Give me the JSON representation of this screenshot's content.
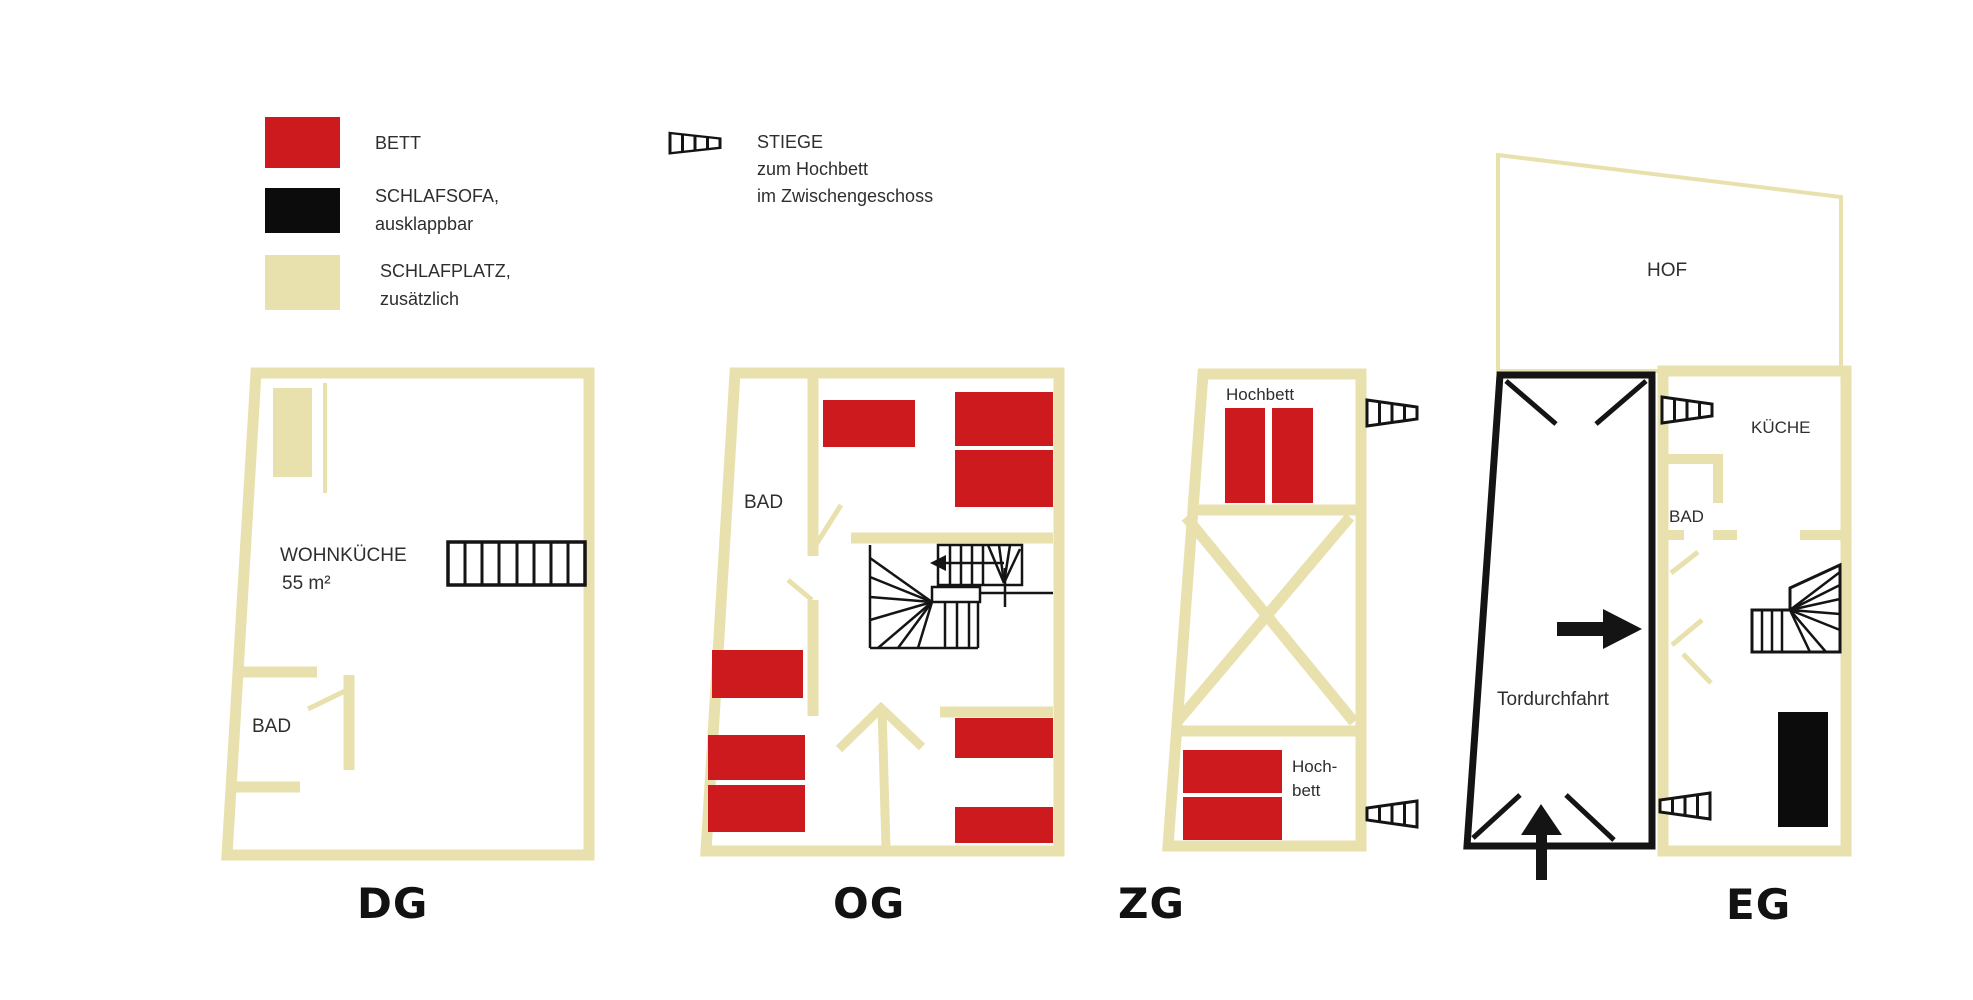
{
  "colors": {
    "bett_red": "#cc1a1e",
    "schlafsofa_black": "#0c0c0c",
    "schlafplatz_beige": "#e9e1ad",
    "wall_beige": "#e9e1ad",
    "stair_black": "#141414",
    "text_dark": "#2e2e2e",
    "floor_label": "#121212"
  },
  "legend": {
    "bett_label": "BETT",
    "schlafsofa_line1": "SCHLAFSOFA,",
    "schlafsofa_line2": "ausklappbar",
    "schlafplatz_line1": "SCHLAFPLATZ,",
    "schlafplatz_line2": "zusätzlich",
    "stiege_line1": "STIEGE",
    "stiege_line2": "zum Hochbett",
    "stiege_line3": "im Zwischengeschoss"
  },
  "floors": {
    "dg": {
      "label": "DG",
      "wohnkueche_line1": "WOHNKÜCHE",
      "wohnkueche_line2": "55 m²",
      "bad": "BAD"
    },
    "og": {
      "label": "OG",
      "bad": "BAD"
    },
    "zg": {
      "label": "ZG",
      "hochbett_top": "Hochbett",
      "hochbett_bottom_line1": "Hoch-",
      "hochbett_bottom_line2": "bett"
    },
    "eg": {
      "label": "EG",
      "hof": "HOF",
      "kueche": "KÜCHE",
      "bad": "BAD",
      "tordurchfahrt": "Tordurchfahrt"
    }
  }
}
